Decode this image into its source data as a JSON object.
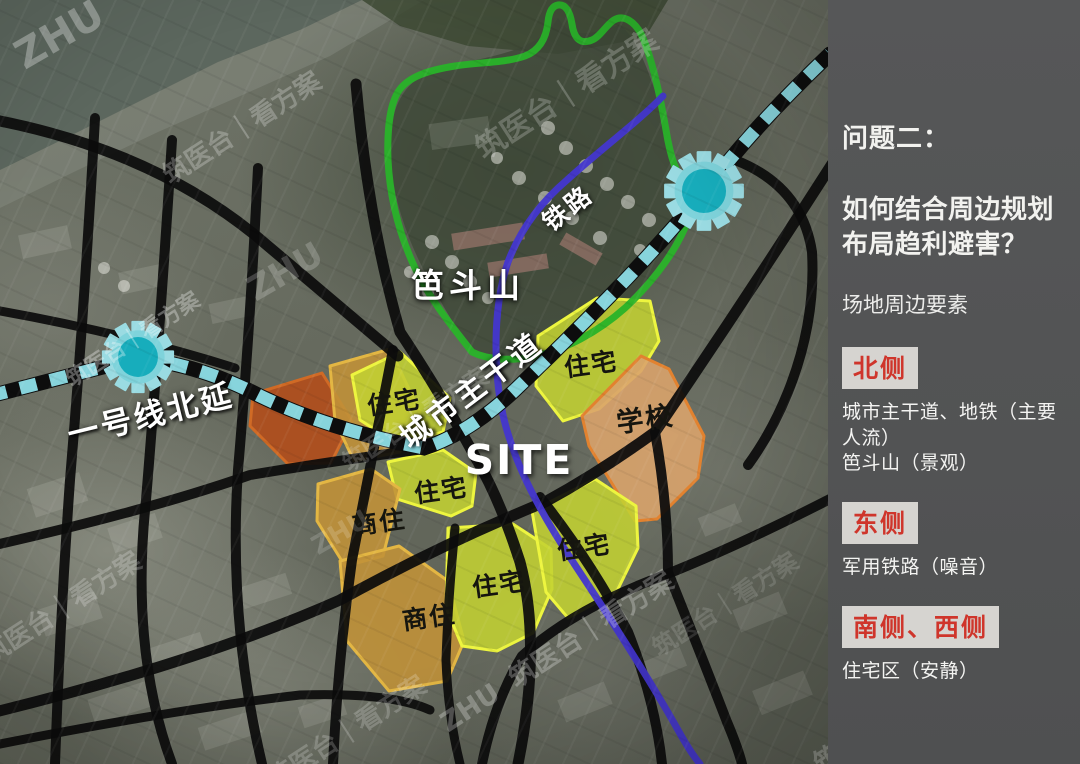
{
  "watermark": {
    "brand": "ZHU",
    "suite": "筑医台｜看方案"
  },
  "map": {
    "labels": {
      "mountain": "笆斗山",
      "railway": "铁路",
      "arterial": "城市主干道",
      "metro": "一号线北延",
      "site": "SITE"
    },
    "zone_labels": [
      {
        "text": "住宅"
      },
      {
        "text": "住宅"
      },
      {
        "text": "住宅"
      },
      {
        "text": "住宅"
      },
      {
        "text": "住宅"
      },
      {
        "text": "商住"
      },
      {
        "text": "商住"
      },
      {
        "text": "学校"
      }
    ]
  },
  "panel": {
    "kicker": "问题二：",
    "title_line1": "如何结合周边规划",
    "title_line2": "布局趋利避害？",
    "subtitle": "场地周边要素",
    "sections": [
      {
        "tag": "北侧",
        "line1": "城市主干道、地铁（主要人流）",
        "line2": "笆斗山（景观）"
      },
      {
        "tag": "东侧",
        "line1": "军用铁路（噪音）",
        "line2": ""
      },
      {
        "tag": "南侧、西侧",
        "line1": "住宅区（安静）",
        "line2": ""
      }
    ]
  },
  "colors": {
    "residential": "#c3d232",
    "mixed_use": "#c09138",
    "school": "#d9a36b",
    "site": "#ea1b2b",
    "metro_dash": "#87d4dc",
    "railway": "#4336cf",
    "greenway": "#29b329",
    "panel_bg": "#545456",
    "tag_red": "#cf352b"
  }
}
